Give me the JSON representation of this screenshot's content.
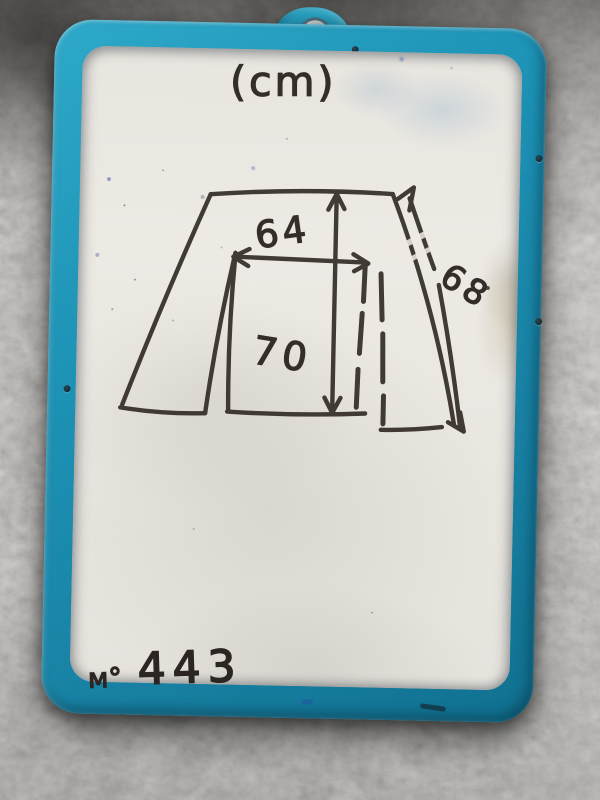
{
  "board": {
    "unit_label": "(cm)",
    "item_number": {
      "prefix": "м°",
      "value": "443"
    }
  },
  "sketch": {
    "type": "hand-drawn garment with dimension arrows",
    "measurements": {
      "width_cm": "64",
      "length_cm": "70",
      "sleeve_cm": "68"
    }
  },
  "colors": {
    "frame_teal": "#1d93b6",
    "frame_teal_dark": "#10708f",
    "board_white": "#eae7e1",
    "marker_ink": "#352e28",
    "carpet_gray": "#8a8781",
    "grommet_metal": "#b9bec2"
  }
}
